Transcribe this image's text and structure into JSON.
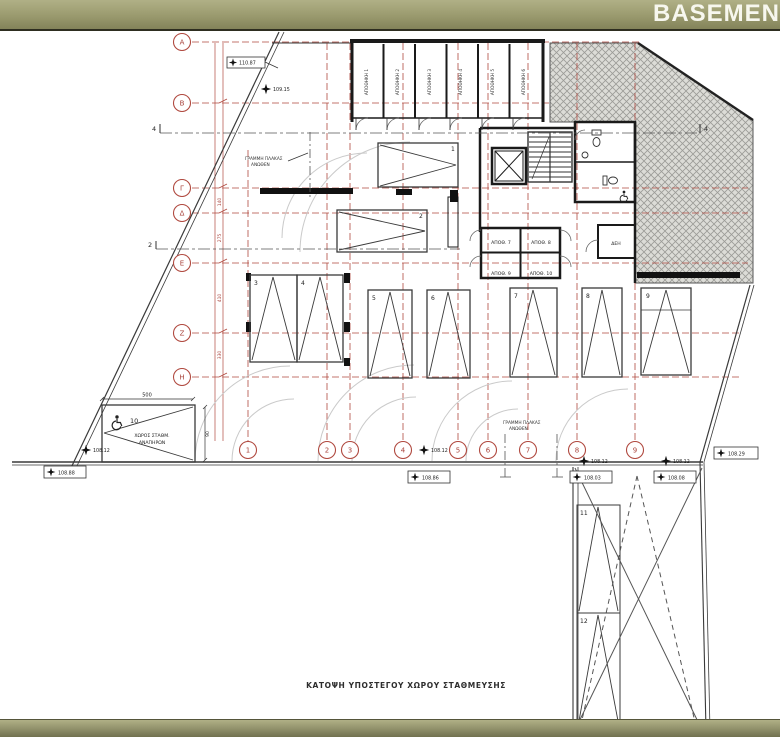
{
  "header": {
    "title": "BASEMEN"
  },
  "plan": {
    "caption": "ΚΑΤΟΨΗ ΥΠΟΣΤΕΓΟΥ ΧΩΡΟΥ ΣΤΑΘΜΕΥΣΗΣ",
    "grid": {
      "columns": [
        "1",
        "2",
        "3",
        "4",
        "5",
        "6",
        "7",
        "8",
        "9"
      ],
      "rows": [
        "Α",
        "Β",
        "Γ",
        "Δ",
        "Ε",
        "Ζ",
        "Η"
      ]
    },
    "storage_rooms": [
      "ΑΠΟΘΗΚΗ 1",
      "ΑΠΟΘΗΚΗ 2",
      "ΑΠΟΘΗΚΗ 3",
      "ΑΠΟΘΗΚΗ 4",
      "ΑΠΟΘΗΚΗ 5",
      "ΑΠΟΘΗΚΗ 6"
    ],
    "small_rooms": [
      "ΑΠΟΘ. 7",
      "ΑΠΟΘ. 8",
      "ΑΠΟΘ. 9",
      "ΑΠΟΘ. 10",
      "ΔΕΗ"
    ],
    "parking_spaces": [
      "1",
      "2",
      "3",
      "4",
      "5",
      "6",
      "7",
      "8",
      "9",
      "10",
      "11",
      "12"
    ],
    "disabled_space": {
      "line1": "ΧΩΡΟΣ ΣΤΑΘΜ.",
      "line2": "ΑΝΑΠΗΡΩΝ"
    },
    "slab_note": {
      "line1": "ΓΡΑΜΜΗ ΠΛΑΚΑΣ",
      "line2": "ΑΝΩΘΕΝ"
    },
    "levels": [
      "110.87",
      "109.15",
      "108.12",
      "108.88",
      "108.12",
      "108.86",
      "108.12",
      "108.03",
      "108.12",
      "108.08",
      "108.29"
    ],
    "dimensions": {
      "width_500": "500",
      "height_90": "90",
      "chain": [
        "140",
        "275",
        "410",
        "330"
      ]
    },
    "sections": {
      "s4": "4",
      "s2": "2"
    }
  },
  "colors": {
    "bar_olive": "#9a9a6e",
    "grid_red": "#a8433b",
    "wall_black": "#1a1a1a",
    "hatch_bg": "#dcdcd7"
  }
}
